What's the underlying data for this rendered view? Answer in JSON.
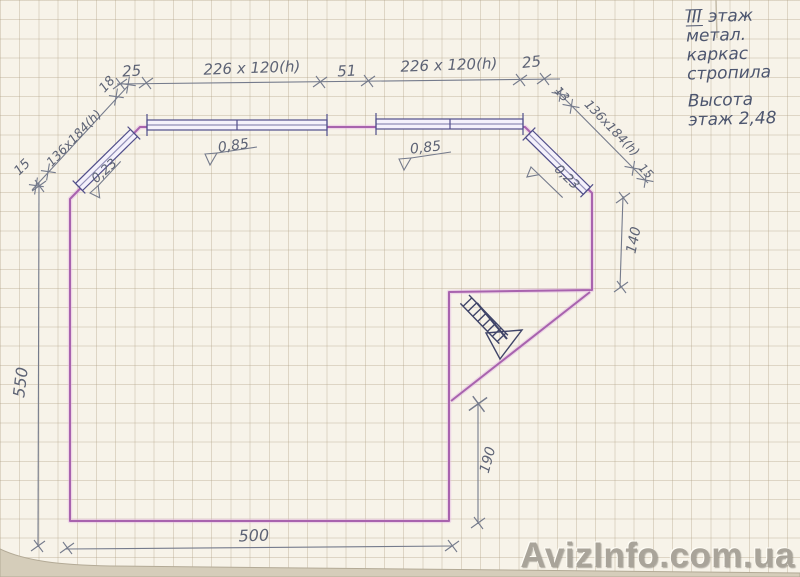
{
  "notes": {
    "floor_roman": "III",
    "floor_word": " этаж",
    "line2": "метал.",
    "line3": "каркас",
    "line4": "стропила",
    "height_label": "Высота",
    "height_value": "этаж 2,48"
  },
  "dims": {
    "top": {
      "left_offset": "25",
      "window_left": "226 x 120(h)",
      "pier": "51",
      "window_right": "226 x 120(h)",
      "right_offset": "25"
    },
    "left_chamfer": {
      "start": "15",
      "window": "136x184(h)",
      "end": "18"
    },
    "right_chamfer": {
      "start": "13",
      "window": "136x184(h)",
      "end": "15"
    },
    "left_wall": "550",
    "bottom_wall": "500",
    "right_wall": "140",
    "stair_opening": "190",
    "levels": {
      "top_left": "0,85",
      "top_right": "0,85",
      "left_chamfer": "0,23",
      "right_chamfer": "0,23"
    }
  },
  "watermark": "AvizInfo.com.ua",
  "colors": {
    "wall": "#a863ae",
    "wall_glow": "#e2b4e2",
    "ink": "#3f4468",
    "window_ink": "#504e8a",
    "pencil": "#757b8c",
    "paper": "#f7f3e9"
  }
}
